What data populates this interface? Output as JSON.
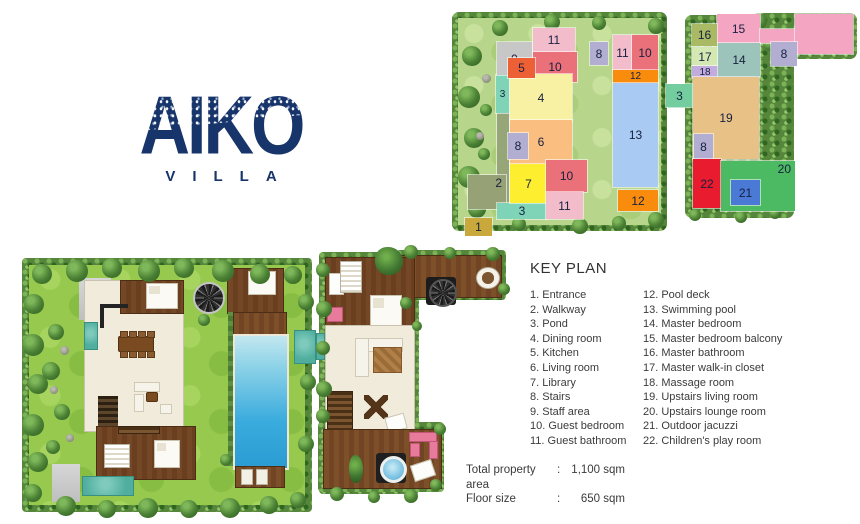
{
  "logo": {
    "title": "AIKO",
    "subtitle": "VILLA"
  },
  "key_plan": {
    "title": "KEY PLAN",
    "column1": [
      "1. Entrance",
      "2. Walkway",
      "3. Pond",
      "4. Dining room",
      "5. Kitchen",
      "6. Living room",
      "7. Library",
      "8. Stairs",
      "9. Staff area",
      "10. Guest bedroom",
      "11. Guest bathroom"
    ],
    "column2": [
      "12. Pool deck",
      "13. Swimming pool",
      "14. Master bedroom",
      "15. Master bedroom balcony",
      "16. Master bathroom",
      "17. Master walk-in closet",
      "18. Massage room",
      "19. Upstairs living room",
      "20. Upstairs lounge room",
      "21. Outdoor jacuzzi",
      "22. Children's play room"
    ]
  },
  "summary": {
    "rows": [
      {
        "label": "Total property area",
        "separator": ":",
        "value": "1,100 sqm"
      },
      {
        "label": "Floor size",
        "separator": ":",
        "value": "650 sqm"
      }
    ]
  },
  "colors": {
    "brand_navy": "#17356a",
    "text": "#3b3b3b"
  },
  "schematics": {
    "ground_floor": {
      "blocks": [
        {
          "n": "",
          "x": 45,
          "y": 101,
          "w": 12,
          "h": 90,
          "c": "#97a678"
        },
        {
          "n": "2",
          "x": 16,
          "y": 163,
          "w": 30,
          "h": 32,
          "c": "#96a176",
          "la": "tr"
        },
        {
          "n": "1",
          "x": 13,
          "y": 206,
          "w": 27,
          "h": 18,
          "c": "#c9a93c"
        },
        {
          "n": "3",
          "x": 45,
          "y": 191,
          "w": 50,
          "h": 16,
          "c": "#7fd4b8"
        },
        {
          "n": "3",
          "x": 44,
          "y": 63,
          "w": 13,
          "h": 38,
          "c": "#7fd4b8"
        },
        {
          "n": "9",
          "x": 45,
          "y": 30,
          "w": 35,
          "h": 33,
          "c": "#c7c7c7"
        },
        {
          "n": "11",
          "x": 81,
          "y": 16,
          "w": 42,
          "h": 24,
          "c": "#f3bcca"
        },
        {
          "n": "10",
          "x": 81,
          "y": 40,
          "w": 44,
          "h": 30,
          "c": "#ea7079"
        },
        {
          "n": "4",
          "x": 58,
          "y": 62,
          "w": 62,
          "h": 48,
          "c": "#f8f0a2"
        },
        {
          "n": "5",
          "x": 56,
          "y": 46,
          "w": 27,
          "h": 20,
          "c": "#ed5f35"
        },
        {
          "n": "6",
          "x": 58,
          "y": 108,
          "w": 62,
          "h": 44,
          "c": "#f9be80"
        },
        {
          "n": "8",
          "x": 56,
          "y": 121,
          "w": 20,
          "h": 26,
          "c": "#b2aed1"
        },
        {
          "n": "7",
          "x": 58,
          "y": 152,
          "w": 37,
          "h": 39,
          "c": "#fdee2f"
        },
        {
          "n": "10",
          "x": 94,
          "y": 148,
          "w": 41,
          "h": 32,
          "c": "#ea7079"
        },
        {
          "n": "11",
          "x": 94,
          "y": 180,
          "w": 37,
          "h": 27,
          "c": "#f3bcca"
        },
        {
          "n": "8",
          "x": 138,
          "y": 30,
          "w": 18,
          "h": 23,
          "c": "#b2aed1"
        },
        {
          "n": "11",
          "x": 161,
          "y": 23,
          "w": 19,
          "h": 35,
          "c": "#f3bcca"
        },
        {
          "n": "10",
          "x": 180,
          "y": 23,
          "w": 26,
          "h": 35,
          "c": "#ea7079"
        },
        {
          "n": "12",
          "x": 161,
          "y": 58,
          "w": 45,
          "h": 13,
          "c": "#f98c0d"
        },
        {
          "n": "13",
          "x": 161,
          "y": 71,
          "w": 45,
          "h": 104,
          "c": "#a9caf2"
        },
        {
          "n": "12",
          "x": 166,
          "y": 178,
          "w": 40,
          "h": 21,
          "c": "#f98c0d"
        },
        {
          "n": "3",
          "x": 216,
          "y": 73,
          "w": 24,
          "h": 23,
          "c": "#74cd9f"
        }
      ]
    },
    "upper_floor": {
      "blocks": [
        {
          "n": "15",
          "x": 52,
          "y": 1,
          "w": 43,
          "h": 29,
          "c": "#f4a5c2"
        },
        {
          "n": "",
          "x": 95,
          "y": 16,
          "w": 36,
          "h": 14,
          "c": "#f4a5c2"
        },
        {
          "n": "",
          "x": 130,
          "y": 1,
          "w": 58,
          "h": 40,
          "c": "#f4a5c2"
        },
        {
          "n": "16",
          "x": 27,
          "y": 11,
          "w": 25,
          "h": 22,
          "c": "#a9b964"
        },
        {
          "n": "17",
          "x": 27,
          "y": 34,
          "w": 26,
          "h": 19,
          "c": "#d4e8b4"
        },
        {
          "n": "18",
          "x": 27,
          "y": 53,
          "w": 26,
          "h": 12,
          "c": "#c2abdd"
        },
        {
          "n": "14",
          "x": 53,
          "y": 30,
          "w": 42,
          "h": 34,
          "c": "#9dc4ba"
        },
        {
          "n": "8",
          "x": 106,
          "y": 29,
          "w": 26,
          "h": 24,
          "c": "#b2aed1"
        },
        {
          "n": "3",
          "x": 1,
          "y": 71,
          "w": 27,
          "h": 23,
          "c": "#74cd9f"
        },
        {
          "n": "19",
          "x": 28,
          "y": 64,
          "w": 66,
          "h": 82,
          "c": "#e7c185"
        },
        {
          "n": "8",
          "x": 29,
          "y": 121,
          "w": 19,
          "h": 25,
          "c": "#b2aed1"
        },
        {
          "n": "22",
          "x": 28,
          "y": 146,
          "w": 28,
          "h": 49,
          "c": "#e81c2e"
        },
        {
          "n": "20",
          "x": 56,
          "y": 148,
          "w": 66,
          "h": 48,
          "c": "#4cba62",
          "la": "tr"
        },
        {
          "n": "21",
          "x": 66,
          "y": 167,
          "w": 29,
          "h": 25,
          "c": "#4a79d6"
        }
      ]
    }
  }
}
